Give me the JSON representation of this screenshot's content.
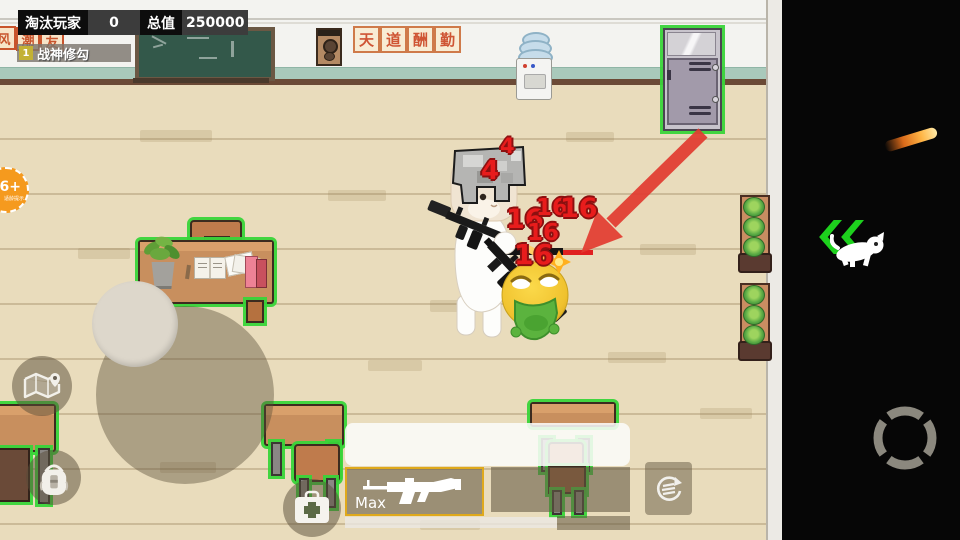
{
  "hud": {
    "eliminated_label": "淘汰玩家",
    "eliminated_value": "0",
    "total_label": "总值",
    "total_value": "250000",
    "rank": "1",
    "player_name": "战神修勾",
    "age_badge": "6+",
    "age_badge_sub": "适龄提示",
    "weapon_name": "Max"
  },
  "wall": {
    "banner_chars": [
      "天",
      "道",
      "酬",
      "勤"
    ],
    "left_banner_chars": [
      "风",
      "潮",
      "友"
    ]
  },
  "damage_numbers": [
    "4",
    "4",
    "16",
    "16",
    "16",
    "16",
    "16"
  ],
  "icons": {
    "map": "map-icon",
    "backpack": "backpack-icon",
    "medkit": "medkit-icon",
    "switch": "switch-weapon-icon",
    "fire": "fire-ring-icon",
    "sprint": "sprint-chevrons-icon"
  },
  "colors": {
    "highlight_green": "#39d439",
    "damage_red": "#e81c1c",
    "slot_border_gold": "#dfa91c",
    "arrow_red": "#e23b30",
    "hud_black": "#0d0d0d",
    "rank_badge_yellow": "#c3b135",
    "floor_beige": "#e9dcbc"
  }
}
